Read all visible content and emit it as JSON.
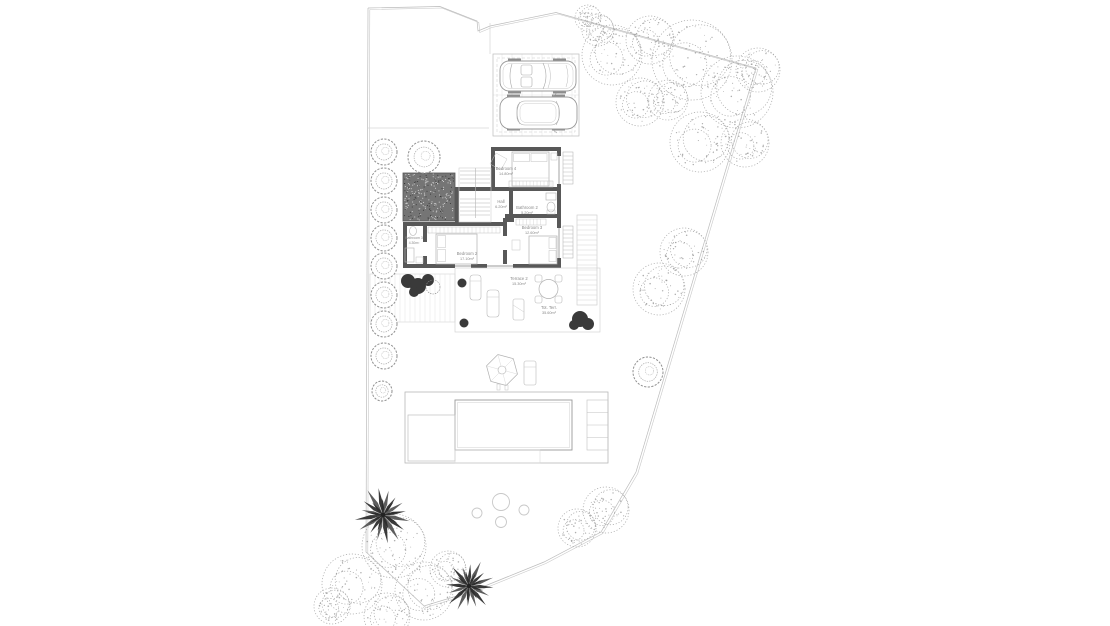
{
  "plan_type": "villa site plan / upper floor plan",
  "rooms": {
    "bedroom4": {
      "name": "Bedroom 4",
      "area": "14.80m²"
    },
    "hall": {
      "name": "Hall",
      "area": "6.20m²"
    },
    "bathroom2": {
      "name": "Bathroom 2",
      "area": "5.20m²"
    },
    "bedroom3": {
      "name": "Bedroom 3",
      "area": "12.60m²"
    },
    "bedroom2": {
      "name": "Bedroom 2",
      "area": "17.10m²"
    },
    "bathroom3": {
      "name": "Bathroom 3",
      "area": "4.30m²"
    },
    "terrace2": {
      "name": "Terrace 2",
      "area": "15.30m²"
    },
    "terraceTot": {
      "name": "Tot. Terr.",
      "area": "35.60m²"
    }
  },
  "site": {
    "features": [
      "property-boundary",
      "driveway",
      "parking-2-cars",
      "gravel-patio",
      "hedge-row-left",
      "staircase",
      "rear-terrace",
      "outdoor-dining-set",
      "sun-loungers",
      "parasol",
      "swimming-pool",
      "pool-deck-steps",
      "stepping-stones",
      "garden-trees",
      "palm-trees"
    ]
  },
  "colors": {
    "background": "#ffffff",
    "wall": "#585858",
    "line": "#9a9a9a",
    "faint": "#d0d0d0",
    "boundary": "#b8b8b8",
    "text": "#8a8a8a",
    "gravel": "#757575",
    "dark_plant": "#3a3a3a"
  }
}
